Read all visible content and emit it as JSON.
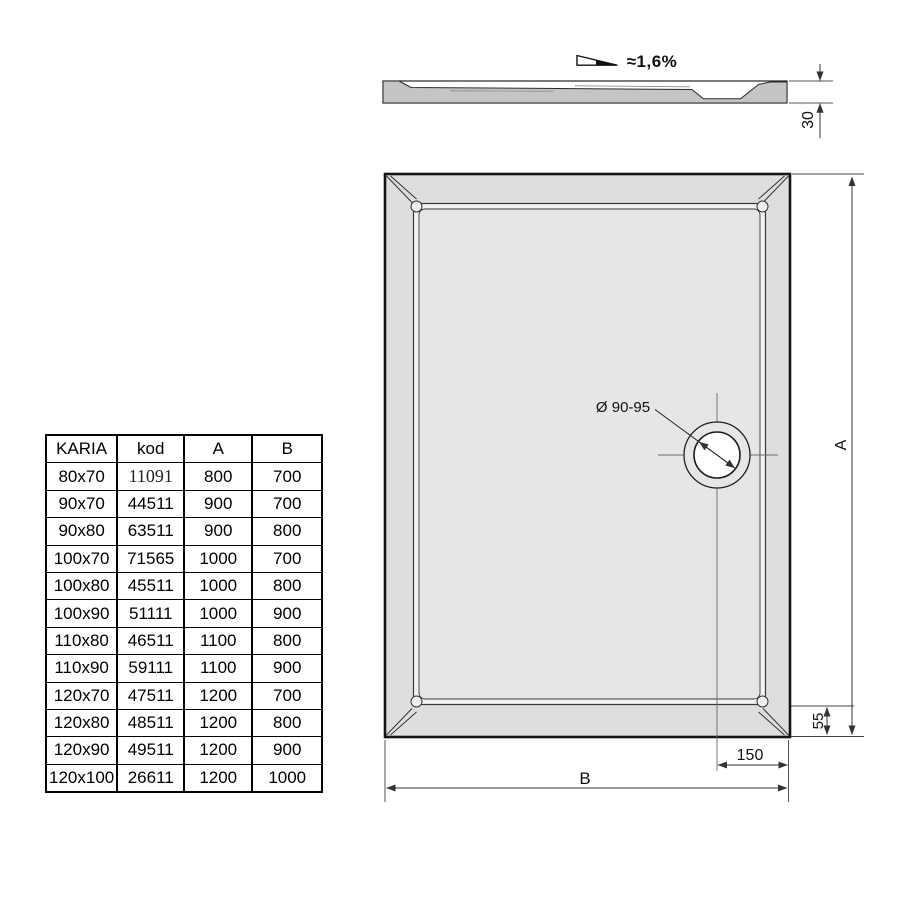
{
  "drawing": {
    "slope_label": "≈1,6%",
    "height_label": "30",
    "drain_label": "Ø 90-95",
    "dim_a_label": "A",
    "dim_b_label": "B",
    "dim_150_label": "150",
    "dim_55_label": "55",
    "icons": {
      "slope_symbol": "slope-triangle-icon"
    },
    "colors": {
      "line": "#222222",
      "outer_band_fill": "#dedee0",
      "floor_fill": "#e6e6e8",
      "rim_fill": "#f3f3f5",
      "profile_fill": "#c5c5c7",
      "background": "#ffffff"
    }
  },
  "table": {
    "headers": [
      "KARIA",
      "kod",
      "A",
      "B"
    ],
    "rows": [
      [
        "80x70",
        "11091",
        "800",
        "700"
      ],
      [
        "90x70",
        "44511",
        "900",
        "700"
      ],
      [
        "90x80",
        "63511",
        "900",
        "800"
      ],
      [
        "100x70",
        "71565",
        "1000",
        "700"
      ],
      [
        "100x80",
        "45511",
        "1000",
        "800"
      ],
      [
        "100x90",
        "51111",
        "1000",
        "900"
      ],
      [
        "110x80",
        "46511",
        "1100",
        "800"
      ],
      [
        "110x90",
        "59111",
        "1100",
        "900"
      ],
      [
        "120x70",
        "47511",
        "1200",
        "700"
      ],
      [
        "120x80",
        "48511",
        "1200",
        "800"
      ],
      [
        "120x90",
        "49511",
        "1200",
        "900"
      ],
      [
        "120x100",
        "26611",
        "1200",
        "1000"
      ]
    ],
    "serif_cell": [
      0,
      1
    ]
  }
}
